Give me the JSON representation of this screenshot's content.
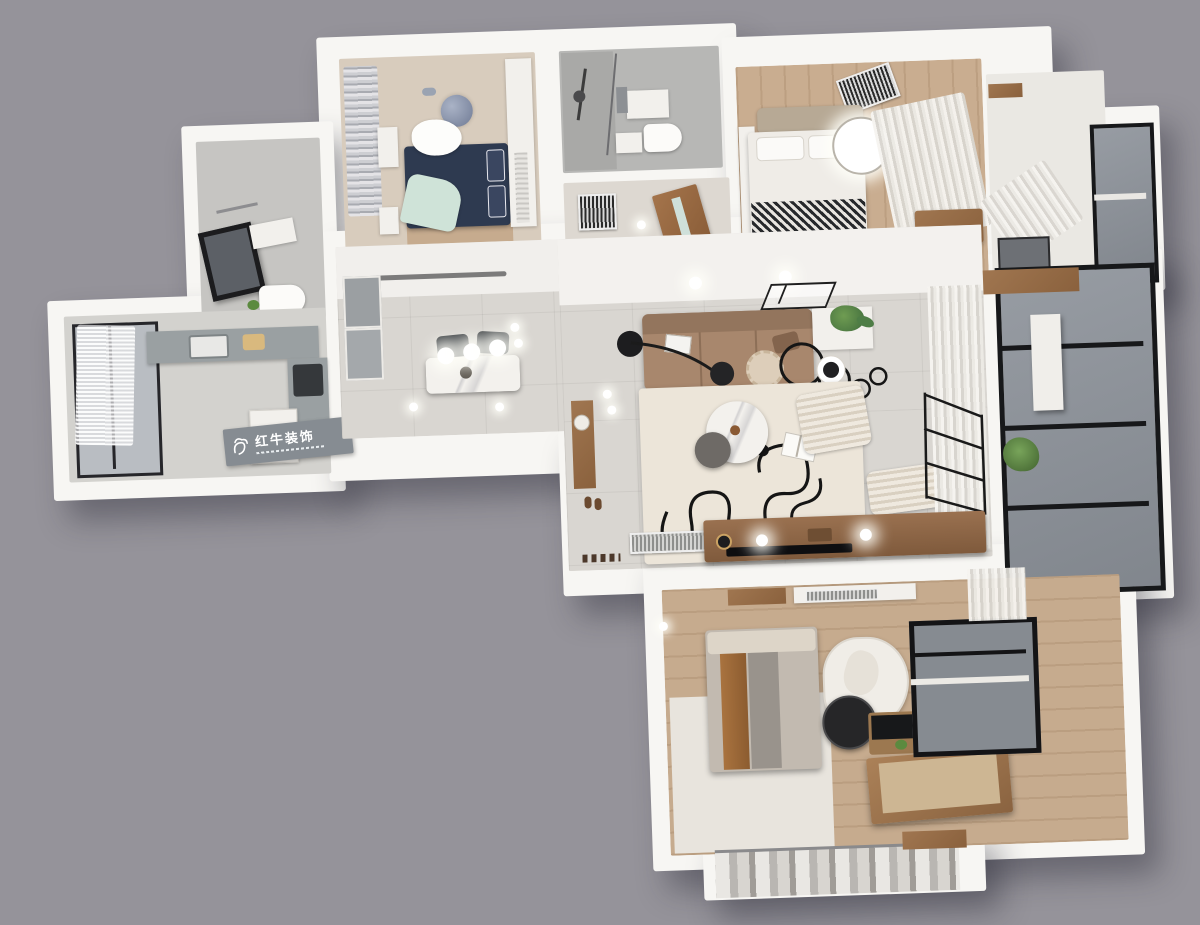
{
  "title": "3D apartment floor plan render (top-down cutaway)",
  "watermark": {
    "brand": "红牛装饰",
    "logo": "bull-logo-icon"
  },
  "palette": {
    "background": "#95939a",
    "walls": "#f7f6f3",
    "tile_floor": "#d9d6d1",
    "wood_floor": "#c9ad90",
    "dark_wood": "#8f6b49",
    "sofa_brown": "#a8876d",
    "bed_navy": "#2e3a50",
    "mint_throw": "#cfe3d8",
    "accent_black": "#1b1b1b",
    "glass_gray": "#8e939a",
    "rug_cream": "#ece5d9",
    "counter_gray": "#9aa0a2",
    "plant_green": "#4e7d46",
    "plaque_gray": "#868c92"
  },
  "scene": {
    "rooms": [
      {
        "name": "kids-bedroom",
        "position": "top-left",
        "items": [
          "navy bed",
          "mint throw blanket",
          "white cloud rug",
          "moon wall decal",
          "gray curtains",
          "wardrobe",
          "dresser",
          "nightstand"
        ]
      },
      {
        "name": "shower-bathroom",
        "position": "top-center",
        "items": [
          "shower set",
          "glass partition",
          "vanity with mirror",
          "toilet"
        ]
      },
      {
        "name": "hallway",
        "position": "center-top",
        "items": [
          "wooden door",
          "striped floor vent"
        ]
      },
      {
        "name": "master-bedroom-top",
        "position": "top-right",
        "items": [
          "white double bed",
          "zigzag blanket",
          "round ceiling lamp",
          "sheer curtains",
          "wood bench",
          "AC vent grille",
          "wardrobe corridor"
        ]
      },
      {
        "name": "guest-bathroom",
        "position": "left",
        "items": [
          "black framed mirror",
          "vanity",
          "toilet",
          "towel bar"
        ]
      },
      {
        "name": "kitchen",
        "position": "far-left",
        "items": [
          "window with sheer curtain",
          "gray countertop",
          "sink",
          "cooktop",
          "refrigerator"
        ]
      },
      {
        "name": "dining-area",
        "position": "center-left",
        "items": [
          "marble dining table",
          "two dark chairs",
          "three globe pendants",
          "built-in gray cabinets",
          "linear ceiling light"
        ]
      },
      {
        "name": "living-room",
        "position": "center",
        "items": [
          "brown sofa",
          "arc floor lamp",
          "scalloped pouf",
          "plant side table",
          "ring wall decor",
          "cream rug with black scribbles",
          "marble coffee tables",
          "ribbed lounge chair and ottoman",
          "open book",
          "TV console with flat TV",
          "AC vent",
          "drying rack",
          "sheer curtains",
          "entry cabinet"
        ]
      },
      {
        "name": "balcony",
        "position": "right",
        "items": [
          "black framed glazing",
          "white board",
          "potted plant",
          "wood shelf"
        ]
      },
      {
        "name": "bedroom-bottom",
        "position": "bottom",
        "items": [
          "bed with brown stripe cover",
          "white irregular rug",
          "black round chair",
          "vanity desk",
          "wood chest",
          "black framed window",
          "curtains",
          "wall shelf",
          "AC vent"
        ]
      },
      {
        "name": "walk-in-closet",
        "position": "bottom-edge",
        "items": [
          "hanging clothes"
        ]
      }
    ]
  }
}
